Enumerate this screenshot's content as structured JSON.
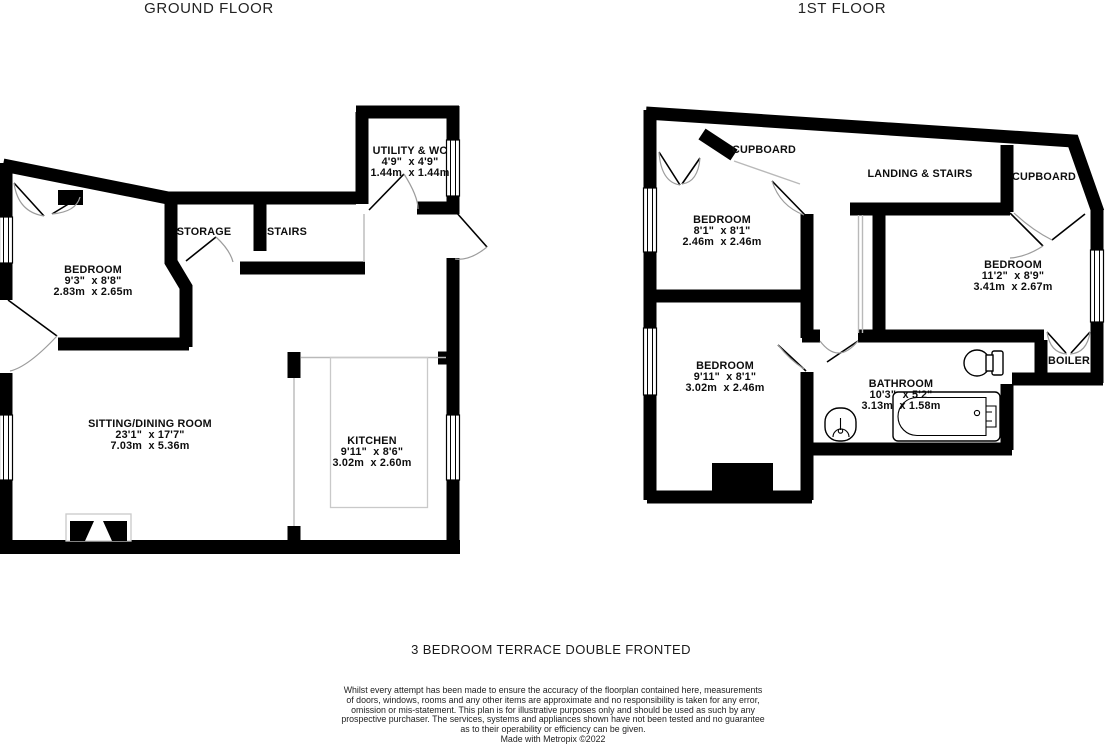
{
  "titles": {
    "ground": "GROUND FLOOR",
    "first": "1ST FLOOR"
  },
  "rooms": {
    "utility": {
      "name": "UTILITY & WC",
      "imperial": "4'9\"  x 4'9\"",
      "metric": "1.44m  x 1.44m"
    },
    "storage": {
      "name": "STORAGE"
    },
    "stairs": {
      "name": "STAIRS"
    },
    "bedroom_gf": {
      "name": "BEDROOM",
      "imperial": "9'3\"  x 8'8\"",
      "metric": "2.83m  x 2.65m"
    },
    "sitting": {
      "name": "SITTING/DINING ROOM",
      "imperial": "23'1\"  x 17'7\"",
      "metric": "7.03m  x 5.36m"
    },
    "kitchen": {
      "name": "KITCHEN",
      "imperial": "9'11\"  x 8'6\"",
      "metric": "3.02m  x 2.60m"
    },
    "cupboard_left": {
      "name": "CUPBOARD"
    },
    "landing": {
      "name": "LANDING & STAIRS"
    },
    "cupboard_right": {
      "name": "CUPBOARD"
    },
    "bedroom1": {
      "name": "BEDROOM",
      "imperial": "8'1\"  x 8'1\"",
      "metric": "2.46m  x 2.46m"
    },
    "bedroom2": {
      "name": "BEDROOM",
      "imperial": "11'2\"  x 8'9\"",
      "metric": "3.41m  x 2.67m"
    },
    "bedroom3": {
      "name": "BEDROOM",
      "imperial": "9'11\"  x 8'1\"",
      "metric": "3.02m  x 2.46m"
    },
    "bathroom": {
      "name": "BATHROOM",
      "imperial": "10'3\"  x 5'2\"",
      "metric": "3.13m  x 1.58m"
    },
    "boiler": {
      "name": "BOILER"
    }
  },
  "footer": {
    "headline": "3 BEDROOM TERRACE DOUBLE FRONTED",
    "disclaimer_lines": [
      "Whilst every attempt has been made to ensure the accuracy of the floorplan contained here, measurements",
      "of doors, windows, rooms and any other items are approximate and no responsibility is taken for any error,",
      "omission or mis-statement. This plan is for illustrative purposes only and should be used as such by any",
      "prospective purchaser. The services, systems and appliances shown have not been tested and no guarantee",
      "as to their operability or efficiency can be given."
    ],
    "credit": "Made with Metropix ©2022"
  },
  "colors": {
    "wall": "#000000",
    "thin_line": "#b9b9b9",
    "text": "#1a1a1a"
  }
}
